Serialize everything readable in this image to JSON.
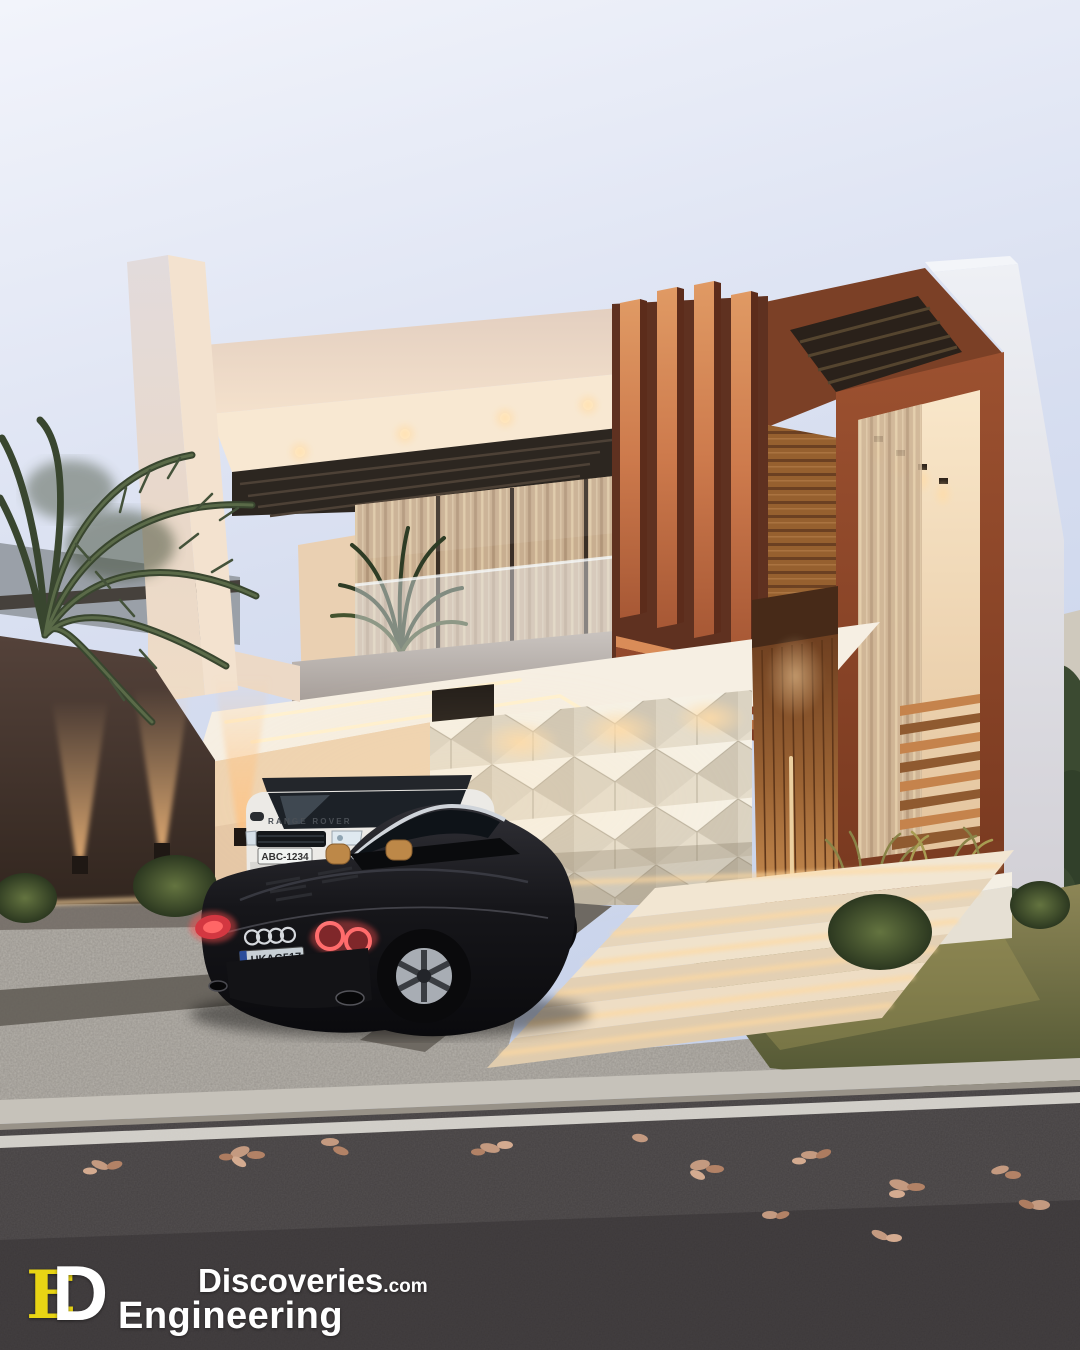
{
  "watermark": {
    "monogram_e": "E",
    "monogram_d": "D",
    "brand_top": "Discoveries",
    "brand_top_suffix": ".com",
    "brand_bottom": "Engineering"
  },
  "vehicles": {
    "suv": {
      "description_icon": "range-rover-suv",
      "hood_text": "RANGE ROVER",
      "license_plate": "ABC-1234"
    },
    "convertible": {
      "description_icon": "audi-r8-spyder",
      "badge_icon": "audi-rings-icon",
      "license_plate": "UKAG517"
    }
  },
  "palette": {
    "logo-yellow": "#e8d414",
    "sky_top": "#eff2fb",
    "sky_low": "#c9d4ea",
    "cream_facade": "#ecd9c7",
    "cream_lit": "#f8e8d2",
    "copper_fin": "#d98c58",
    "corten_frame": "#8e4a2c",
    "wood_door": "#a96f3f",
    "louver_dark": "#2d2620",
    "perimeter_wall": "#43352c",
    "white_parapet": "#e7e8ee",
    "slab_gray": "#c9c3bf",
    "cobblestone": "#b6b2ab",
    "asphalt": "#454142",
    "lawn": "#6f7040",
    "bush_green": "#48572e",
    "warm_glow": "#ffd9a0"
  }
}
